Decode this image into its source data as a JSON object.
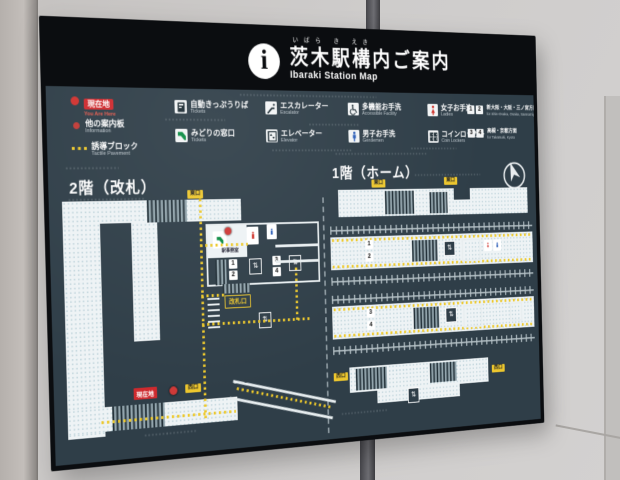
{
  "sign": {
    "title_furigana": "いばら き えき",
    "title_ja": "茨木駅構内ご案内",
    "title_en": "Ibaraki Station Map",
    "info_glyph": "i",
    "panel_color": "#2f3e48",
    "accent_yellow": "#edc72e",
    "accent_red": "#ce2a2e"
  },
  "legend": {
    "you_are_here": {
      "ja": "現在地",
      "en": "You Are Here"
    },
    "information": {
      "ja": "他の案内板",
      "en": "Information"
    },
    "tactile": {
      "ja": "誘導ブロック",
      "en": "Tactile Pavement"
    },
    "ticket_machines": {
      "ja": "自動きっぷうりば",
      "en": "Tickets"
    },
    "midori_madoguchi": {
      "ja": "みどりの窓口",
      "en": "Tickets"
    },
    "escalator": {
      "ja": "エスカレーター",
      "en": "Escalator"
    },
    "elevator": {
      "ja": "エレベーター",
      "en": "Elevator"
    },
    "accessible": {
      "ja": "多機能お手洗",
      "en": "Accessible Facility"
    },
    "gentlemen": {
      "ja": "男子お手洗",
      "en": "Gentlemen"
    },
    "ladies": {
      "ja": "女子お手洗",
      "en": "Ladies"
    },
    "coin_lockers": {
      "ja": "コインロッカー",
      "en": "Coin Lockers"
    },
    "dir_osaka": {
      "num1": "1",
      "num2": "2",
      "ja": "新大阪・大阪・三ノ宮方面",
      "en": "for Shin-Osaka, Osaka, Sannomiya"
    },
    "dir_kyoto": {
      "num1": "3",
      "num2": "4",
      "ja": "高槻・京都方面",
      "en": "for Takatsuki, Kyoto"
    }
  },
  "compass": {
    "label": "N"
  },
  "floor2": {
    "title": "2階（改札）",
    "east_exit_label": "東口",
    "west_exit_label": "西口",
    "gate_label": "改札口",
    "you_are_here_label": "現在地",
    "office_label": "駅事務室",
    "stair_chips": [
      "1",
      "2",
      "3",
      "4"
    ]
  },
  "floor1": {
    "title": "1階（ホーム）",
    "exit_top_left": "東口",
    "exit_top_right": "東口",
    "exit_bottom_left": "西口",
    "exit_bottom_right": "西口",
    "platform_chips": [
      "1",
      "2",
      "3",
      "4"
    ]
  },
  "icons": {
    "elevator_glyph": "⇅"
  }
}
